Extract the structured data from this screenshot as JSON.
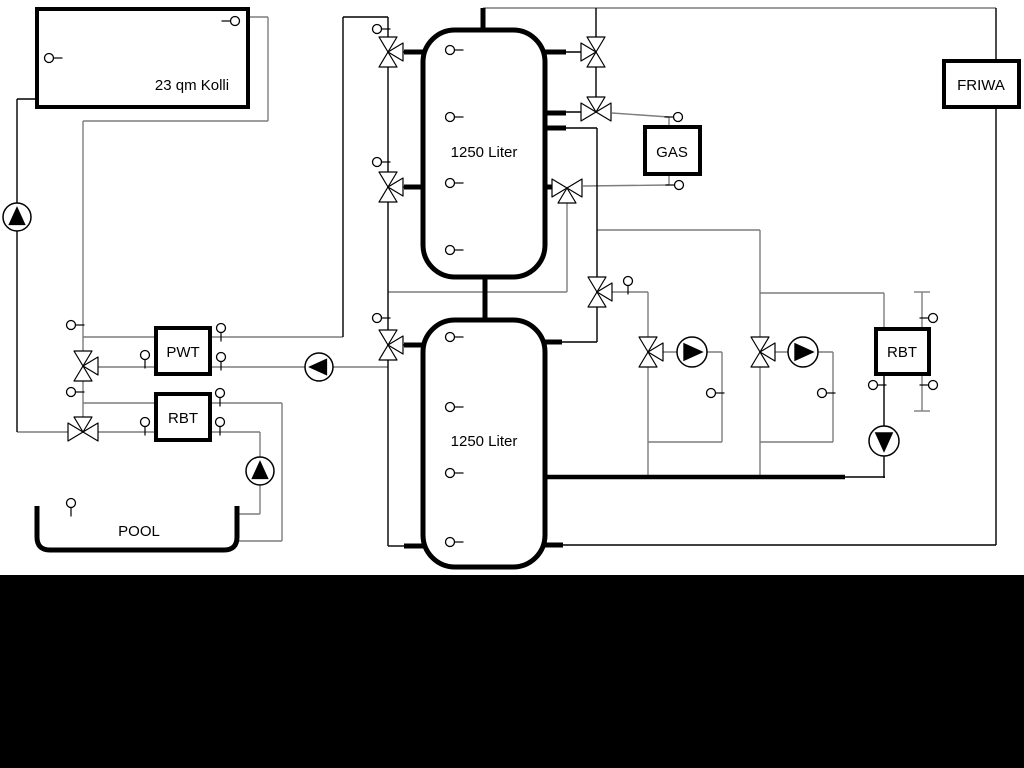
{
  "labels": {
    "collector": "23 qm Kolli",
    "buffer_tank_top": "1250 Liter",
    "buffer_tank_bottom": "1250 Liter",
    "gas_boiler": "GAS",
    "friwa_station": "FRIWA",
    "pwt_heat_exchanger": "PWT",
    "rbt_left": "RBT",
    "rbt_right": "RBT",
    "pool": "POOL"
  },
  "colors": {
    "line_black": "#000000",
    "line_gray": "#7d7d7d",
    "background": "#ffffff",
    "bottom_band": "#000000"
  },
  "components": {
    "valves": [
      {
        "id": "solar-pwt-3way-valve",
        "x": 83,
        "y": 366,
        "main": "v",
        "branch": "right"
      },
      {
        "id": "solar-pool-3way-valve",
        "x": 83,
        "y": 432,
        "main": "h",
        "branch": "top"
      },
      {
        "id": "tank1-top-left-3way-valve",
        "x": 388,
        "y": 52,
        "main": "v",
        "branch": "right"
      },
      {
        "id": "tank1-mid-left-3way-valve",
        "x": 388,
        "y": 187,
        "main": "v",
        "branch": "right"
      },
      {
        "id": "tank2-left-3way-valve",
        "x": 388,
        "y": 345,
        "main": "v",
        "branch": "right"
      },
      {
        "id": "tank1-top-right-3way-valve",
        "x": 596,
        "y": 52,
        "main": "v",
        "branch": "left"
      },
      {
        "id": "gas-flow-3way-valve",
        "x": 596,
        "y": 112,
        "main": "h",
        "branch": "top"
      },
      {
        "id": "gas-return-3way-valve",
        "x": 567,
        "y": 188,
        "main": "h",
        "branch": "bottom"
      },
      {
        "id": "header-3way-valve",
        "x": 597,
        "y": 292,
        "main": "v",
        "branch": "right"
      },
      {
        "id": "circuit1-mixing-valve",
        "x": 648,
        "y": 352,
        "main": "v",
        "branch": "right"
      },
      {
        "id": "circuit2-mixing-valve",
        "x": 760,
        "y": 352,
        "main": "v",
        "branch": "right"
      }
    ],
    "pumps": [
      {
        "id": "solar-pump",
        "x": 17,
        "y": 217,
        "dir": "up",
        "r": 14
      },
      {
        "id": "buffer-charge-pump",
        "x": 319,
        "y": 367,
        "dir": "left",
        "r": 14
      },
      {
        "id": "pool-pump",
        "x": 260,
        "y": 471,
        "dir": "up",
        "r": 14
      },
      {
        "id": "circuit1-pump",
        "x": 692,
        "y": 352,
        "dir": "right",
        "r": 15
      },
      {
        "id": "circuit2-pump",
        "x": 803,
        "y": 352,
        "dir": "right",
        "r": 15
      },
      {
        "id": "rbt-right-pump",
        "x": 884,
        "y": 441,
        "dir": "down",
        "r": 15
      }
    ],
    "sensors": [
      {
        "id": "collector-sensor-top",
        "x": 235,
        "y": 21,
        "stem": "left"
      },
      {
        "id": "collector-sensor-left",
        "x": 49,
        "y": 58,
        "stem": "right"
      },
      {
        "id": "tank1-sensor-1",
        "x": 450,
        "y": 50,
        "stem": "right"
      },
      {
        "id": "tank1-sensor-2",
        "x": 450,
        "y": 117,
        "stem": "right"
      },
      {
        "id": "tank1-sensor-3",
        "x": 450,
        "y": 183,
        "stem": "right"
      },
      {
        "id": "tank1-sensor-4",
        "x": 450,
        "y": 250,
        "stem": "right"
      },
      {
        "id": "tank2-sensor-1",
        "x": 450,
        "y": 337,
        "stem": "right"
      },
      {
        "id": "tank2-sensor-2",
        "x": 450,
        "y": 407,
        "stem": "right"
      },
      {
        "id": "tank2-sensor-3",
        "x": 450,
        "y": 473,
        "stem": "right"
      },
      {
        "id": "tank2-sensor-4",
        "x": 450,
        "y": 542,
        "stem": "right"
      },
      {
        "id": "riser-sensor-top",
        "x": 377,
        "y": 29,
        "stem": "right"
      },
      {
        "id": "riser-sensor-mid",
        "x": 377,
        "y": 162,
        "stem": "right"
      },
      {
        "id": "riser-sensor-bottom",
        "x": 377,
        "y": 318,
        "stem": "right"
      },
      {
        "id": "solar-line-sensor",
        "x": 71,
        "y": 325,
        "stem": "right"
      },
      {
        "id": "pwt-in-sensor",
        "x": 145,
        "y": 355,
        "stem": "down"
      },
      {
        "id": "pwt-out-top-sensor",
        "x": 221,
        "y": 328,
        "stem": "down"
      },
      {
        "id": "pwt-out-bottom-sensor",
        "x": 221,
        "y": 357,
        "stem": "down"
      },
      {
        "id": "rbt-line-sensor",
        "x": 71,
        "y": 392,
        "stem": "right"
      },
      {
        "id": "rbt-in-sensor",
        "x": 145,
        "y": 422,
        "stem": "down"
      },
      {
        "id": "rbt-out-top-sensor",
        "x": 220,
        "y": 393,
        "stem": "down"
      },
      {
        "id": "rbt-out-bottom-sensor",
        "x": 220,
        "y": 422,
        "stem": "down"
      },
      {
        "id": "pool-sensor",
        "x": 71,
        "y": 503,
        "stem": "down"
      },
      {
        "id": "header-valve-sensor",
        "x": 628,
        "y": 281,
        "stem": "down"
      },
      {
        "id": "gas-top-sensor",
        "x": 678,
        "y": 117,
        "stem": "left"
      },
      {
        "id": "gas-bottom-sensor",
        "x": 679,
        "y": 185,
        "stem": "left"
      },
      {
        "id": "circuit1-return-sensor",
        "x": 711,
        "y": 393,
        "stem": "right"
      },
      {
        "id": "circuit2-return-sensor",
        "x": 822,
        "y": 393,
        "stem": "right"
      },
      {
        "id": "rbt-right-return-sensor",
        "x": 873,
        "y": 385,
        "stem": "right"
      },
      {
        "id": "manifold-sensor-top",
        "x": 933,
        "y": 318,
        "stem": "left"
      },
      {
        "id": "manifold-sensor-bottom",
        "x": 933,
        "y": 385,
        "stem": "left"
      }
    ]
  }
}
